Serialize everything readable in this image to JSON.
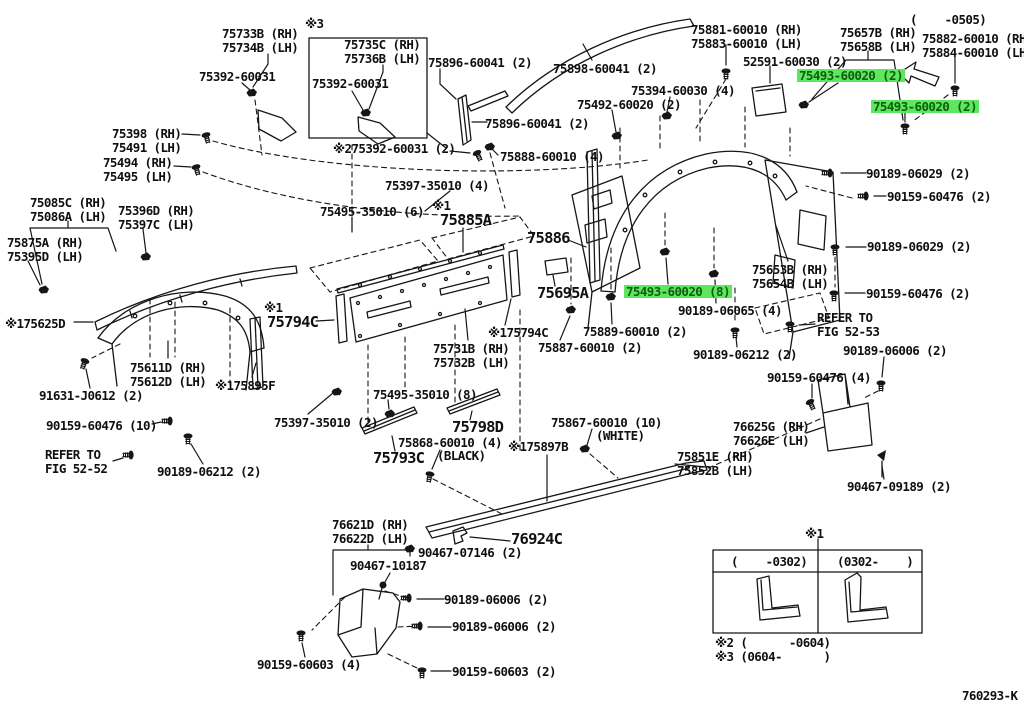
{
  "highlight": {
    "bg": "#5ee65e",
    "fg": "#0a5f0a"
  },
  "top_left": {
    "clip_rh": "75733B (RH)",
    "clip_lh": "75734B (LH)",
    "mark3": "※3",
    "box_clip_rh": "75735C (RH)",
    "box_clip_lh": "75736B (LH)",
    "screw_a": "75392-60031",
    "screw_b": "75392-60031",
    "mark2_screw": "※275392-60031 (2)"
  },
  "top_center": {
    "ws_mldg_a": "75896-60041 (2)",
    "roof_mldg": "75898-60041 (2)",
    "ws_mldg_b": "75896-60041 (2)",
    "clip_set": "75888-60010 (4)",
    "pad": "75492-60020 (2)",
    "clip4": "75394-60030 (4)"
  },
  "top_right": {
    "mldg_a_rh": "75881-60010 (RH)",
    "mldg_a_lh": "75883-60010 (LH)",
    "pad": "52591-60030 (2)",
    "clip_rh": "75657B (RH)",
    "clip_lh": "75658B (LH)",
    "date_range": "(    -0505)",
    "mldg_b_rh": "75882-60010 (RH)",
    "mldg_b_lh": "75884-60010 (LH)",
    "hl_a": "75493-60020 (2)",
    "hl_b": "75493-60020 (2)"
  },
  "left": {
    "p75398": "75398 (RH)",
    "p75491": "75491 (LH)",
    "p75494": "75494 (RH)",
    "p75495": "75495 (LH)",
    "p75085c": "75085C (RH)",
    "p75086a": "75086A (LH)",
    "p75396d": "75396D (RH)",
    "p75397c": "75397C (LH)",
    "p75875a": "75875A (RH)",
    "p75395d": "75395D (LH)",
    "mldg_1625d": "※175625D",
    "flare_rh": "75611D (RH)",
    "flare_lh": "75612D (LH)",
    "strip_1895f": "※175895F",
    "bolt_91631": "91631-J0612 (2)",
    "screw_60476_10": "90159-60476 (10)",
    "refer_line1": "REFER TO",
    "refer_line2": "FIG 52-52",
    "nut_06212": "90189-06212 (2)"
  },
  "center": {
    "clip_75397_4": "75397-35010 (4)",
    "clip_75495_6": "75495-35010 (6)",
    "mark1_a": "※1",
    "rail": "75885A",
    "mark1_b": "※1",
    "cap": "75794C",
    "panel_rh": "75731B (RH)",
    "panel_lh": "75732B (LH)",
    "cap_right": "※175794C",
    "p75886": "75886",
    "p75695a": "75695A",
    "p75889": "75889-60010 (2)",
    "p75887": "75887-60010 (2)",
    "hl_8": "75493-60020 (8)",
    "nut_06065": "90189-06065 (4)",
    "nut_06212": "90189-06212 (2)"
  },
  "right": {
    "flare_rh": "75653B (RH)",
    "flare_lh": "75654B (LH)",
    "nut_06029_a": "90189-06029 (2)",
    "screw_60476_2a": "90159-60476 (2)",
    "nut_06029_b": "90189-06029 (2)",
    "screw_60476_2b": "90159-60476 (2)",
    "refer_line1": "REFER TO",
    "refer_line2": "FIG 52-53",
    "nut_06006": "90189-06006 (2)",
    "screw_60476_4": "90159-60476 (4)",
    "mudguard_rh": "76625G (RH)",
    "mudguard_lh": "76626E (LH)",
    "screw_09189": "90467-09189 (2)"
  },
  "bottom": {
    "clip_75397_2": "75397-35010 (2)",
    "clip_75495_8": "75495-35010 (8)",
    "p75798d": "75798D",
    "tape_75868": "75868-60010 (4)",
    "tape_75868_color": "(BLACK)",
    "p75793c": "75793C",
    "sill_1897b": "※175897B",
    "tape_75867": "75867-60010 (10)",
    "tape_75867_color": "(WHITE)",
    "sill_rh": "75851E (RH)",
    "sill_lh": "75852B (LH)",
    "mudguard_rh": "76621D (RH)",
    "mudguard_lh": "76622D (LH)",
    "screw_10187": "90467-10187",
    "screw_07146": "90467-07146 (2)",
    "p76924c": "76924C",
    "nut_06006_a": "90189-06006 (2)",
    "nut_06006_b": "90189-06006 (2)",
    "screw_60603_2": "90159-60603 (2)",
    "screw_60603_4": "90159-60603 (4)"
  },
  "table": {
    "mark1": "※1",
    "col_a": "(    -0302)",
    "col_b": "(0302-    )",
    "note2": "※2 (      -0604)",
    "note3": "※3 (0604-      )"
  },
  "footer": {
    "doc_code": "760293-K"
  }
}
